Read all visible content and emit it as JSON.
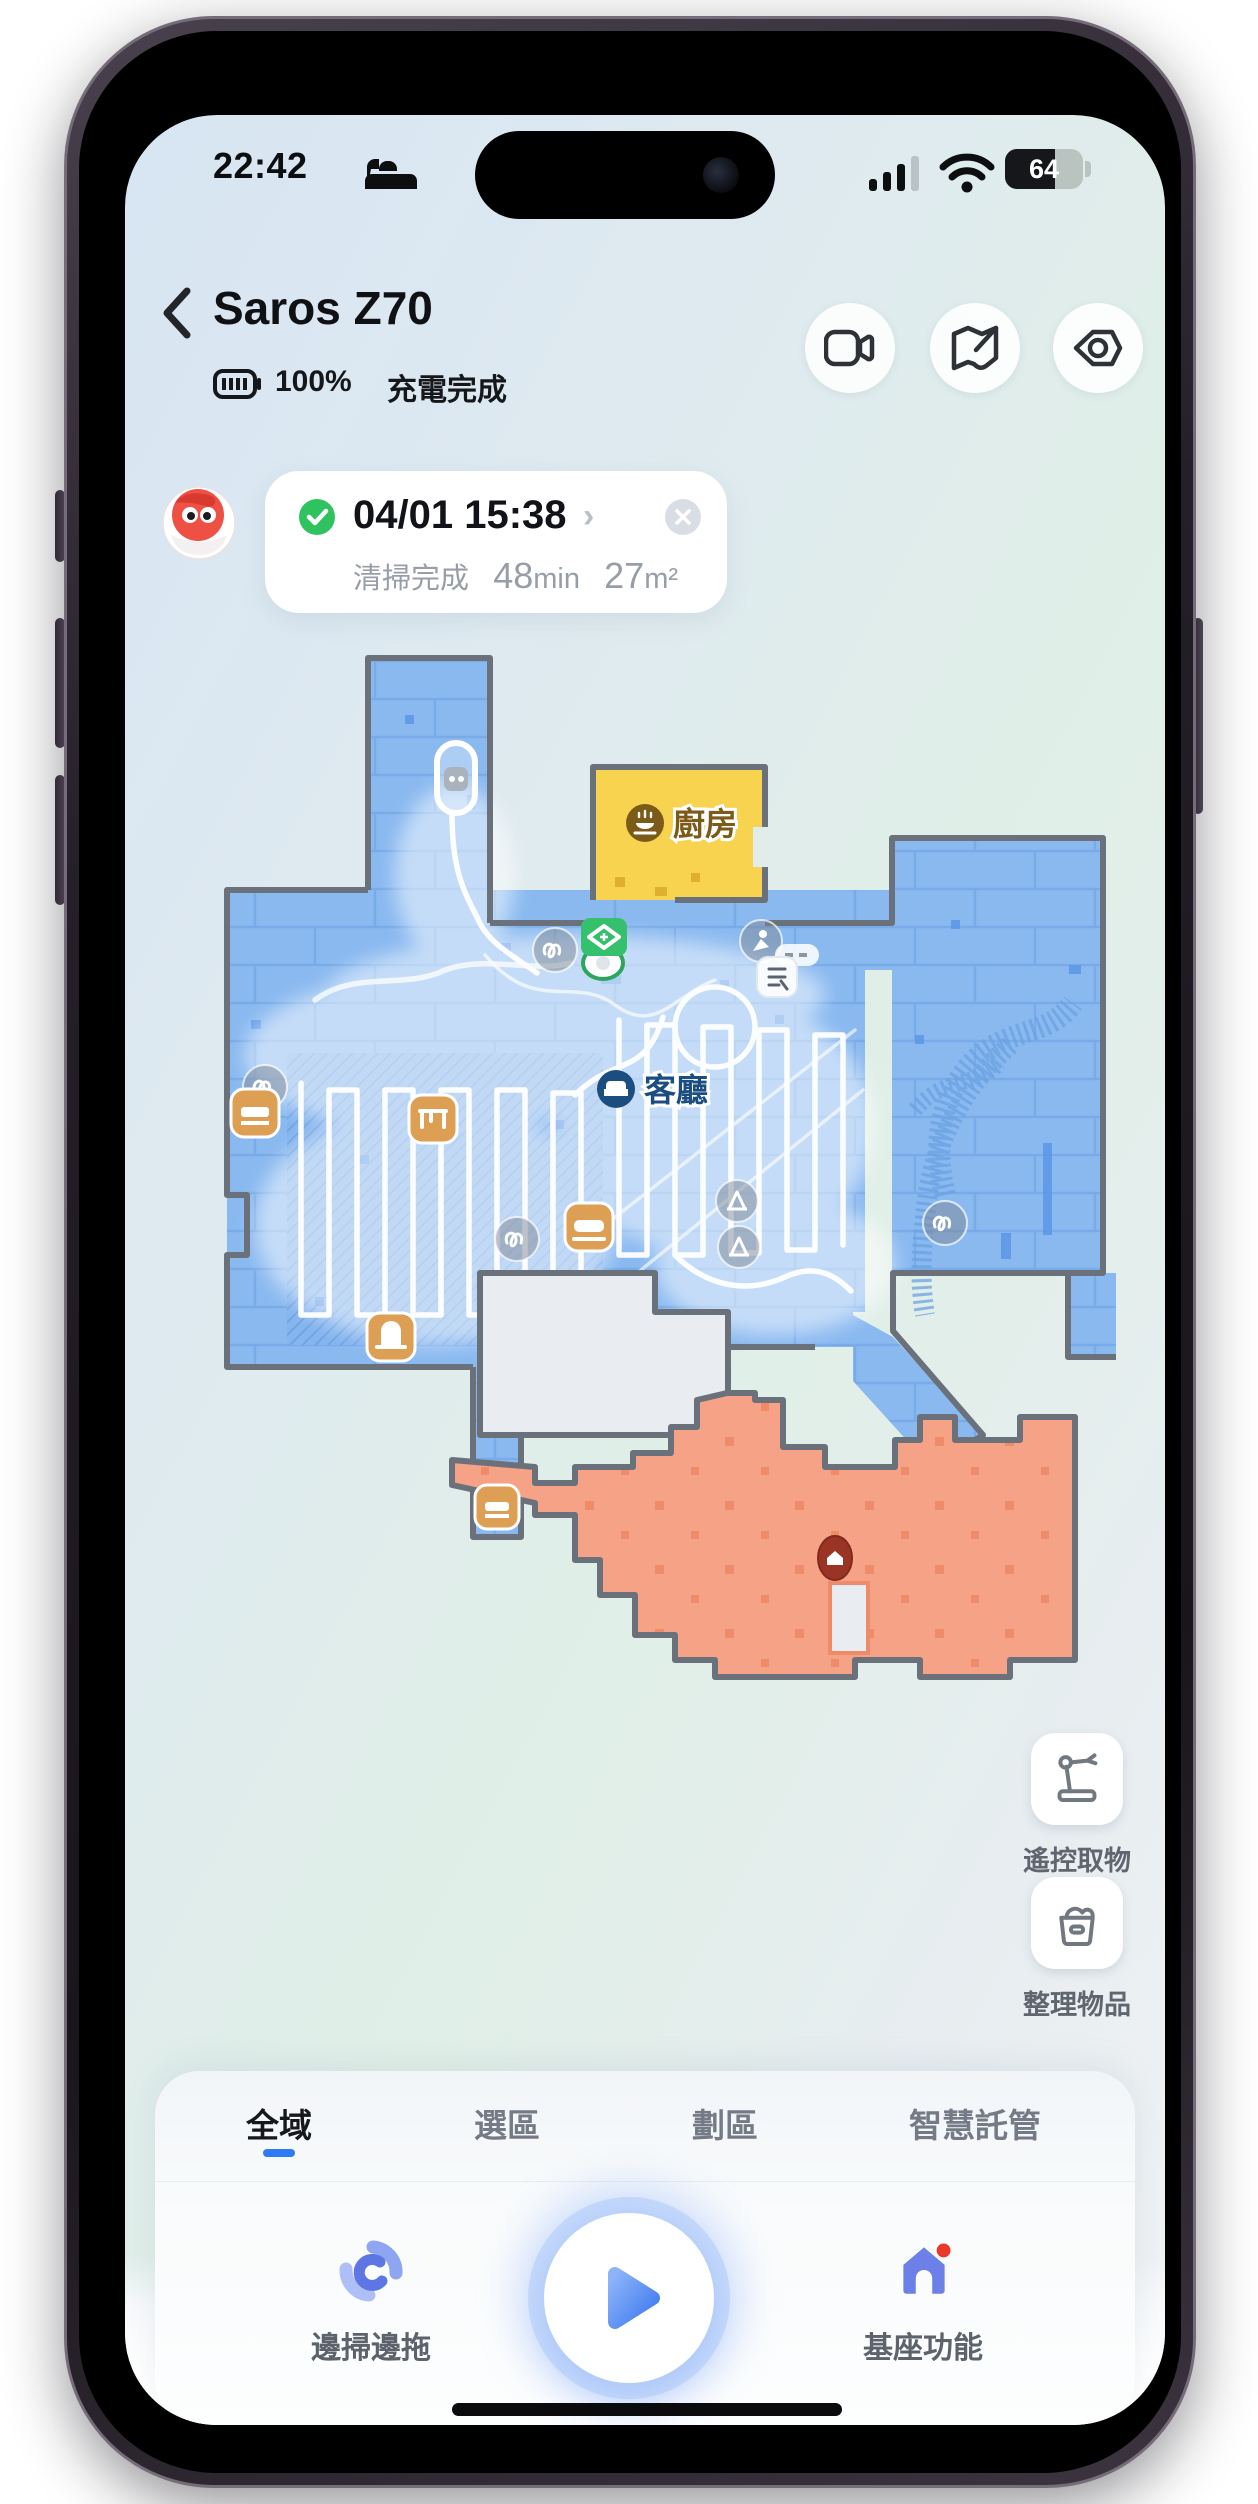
{
  "status_bar": {
    "time": "22:42",
    "battery_level": "64"
  },
  "header": {
    "title": "Saros Z70",
    "battery_percent": "100%",
    "charge_status": "充電完成"
  },
  "task_card": {
    "datetime": "04/01 15:38",
    "status": "清掃完成",
    "duration_value": "48",
    "duration_unit": "min",
    "area_value": "27",
    "area_unit": "m²"
  },
  "map": {
    "rooms": {
      "kitchen": "廚房",
      "living": "客廳"
    }
  },
  "side_actions": {
    "remote_pick": "遙控取物",
    "tidy_items": "整理物品"
  },
  "tabs": [
    {
      "label": "全域",
      "active": true
    },
    {
      "label": "選區",
      "active": false
    },
    {
      "label": "劃區",
      "active": false
    },
    {
      "label": "智慧託管",
      "active": false
    }
  ],
  "controls": {
    "sweep_mop": "邊掃邊拖",
    "dock_functions": "基座功能"
  },
  "colors": {
    "accent_blue": "#2f7bf5",
    "room_blue": "#8ab9f0",
    "room_yellow": "#f8d34f",
    "room_orange": "#f5a287",
    "wall_gray": "#6b717b",
    "dock_green": "#35c06d",
    "status_green": "#2ec35f",
    "alert_red": "#e8392b"
  }
}
